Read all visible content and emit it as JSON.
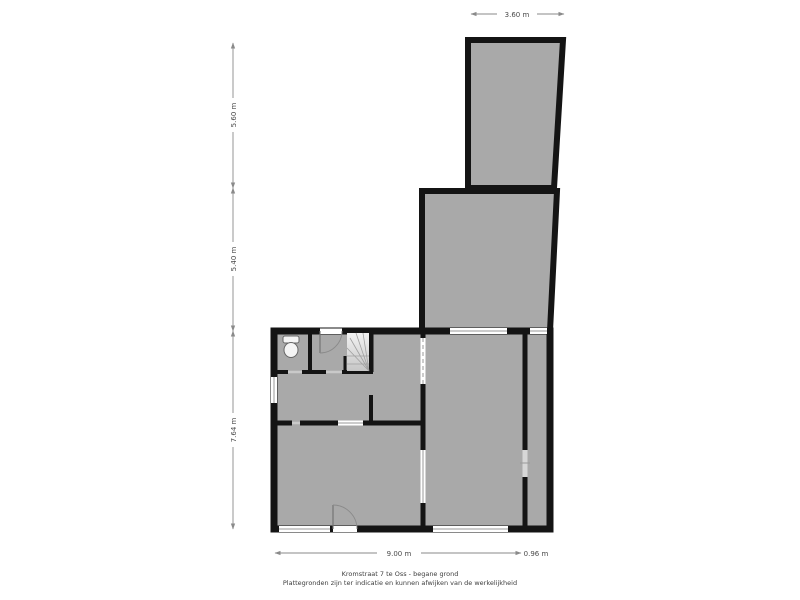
{
  "floor_plan": {
    "caption": {
      "line1": "Kromstraat 7 te Oss - begane grond",
      "line2": "Plattegronden zijn ter indicatie en kunnen afwijken van de werkelijkheid"
    },
    "dimensions": {
      "top_width": "3.60 m",
      "left_top_height": "5.60 m",
      "left_middle_height": "5.40 m",
      "left_bottom_height": "7.64 m",
      "bottom_width_main": "9.00 m",
      "bottom_width_right": "0.96 m"
    },
    "colors": {
      "wall": "#141414",
      "floor": "#a9a9a9",
      "background": "#ffffff",
      "dimension_line": "#8a8a8a",
      "window": "#ffffff"
    }
  }
}
